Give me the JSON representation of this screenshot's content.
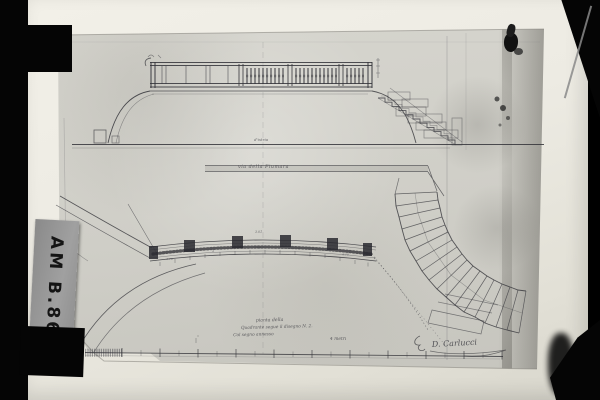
{
  "archive_label": {
    "text": "AM B.86"
  },
  "colors": {
    "background": "#000000",
    "backing_paper": "#edebe3",
    "drawing_paper": "#cfcec7",
    "ink": "#34343a",
    "label_background": "#969696",
    "label_text": "#141414"
  },
  "annotations": {
    "elevation_note": "d'istria",
    "street_note": "via della Fiumara",
    "plan_center_dim": "3.01",
    "plan_dims": [
      "4.10",
      "4",
      "2.60",
      "4",
      "4.10"
    ],
    "caption_line1": "pianta della",
    "caption_line2": "Quadrante segue il disegno N. 2.",
    "caption_line3": "Col segno annesso",
    "scale_label": "4 metri",
    "signature": "D. Carlucci"
  }
}
